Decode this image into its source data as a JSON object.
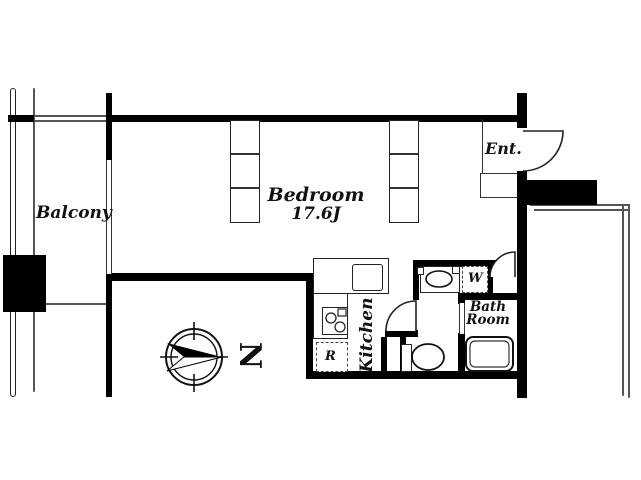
{
  "plan": {
    "balcony": {
      "label": "Balcony"
    },
    "bedroom": {
      "label": "Bedroom",
      "size": "17.6J"
    },
    "entrance": {
      "label": "Ent."
    },
    "kitchen": {
      "label": "Kitchen"
    },
    "bathroom": {
      "label_line1": "Bath",
      "label_line2": "Room"
    },
    "washing_machine": {
      "label": "W"
    },
    "refrigerator": {
      "label": "R"
    },
    "compass": {
      "north_label": "N"
    }
  },
  "colors": {
    "wall": "#000000",
    "thin_line": "#555555",
    "background": "#ffffff"
  }
}
